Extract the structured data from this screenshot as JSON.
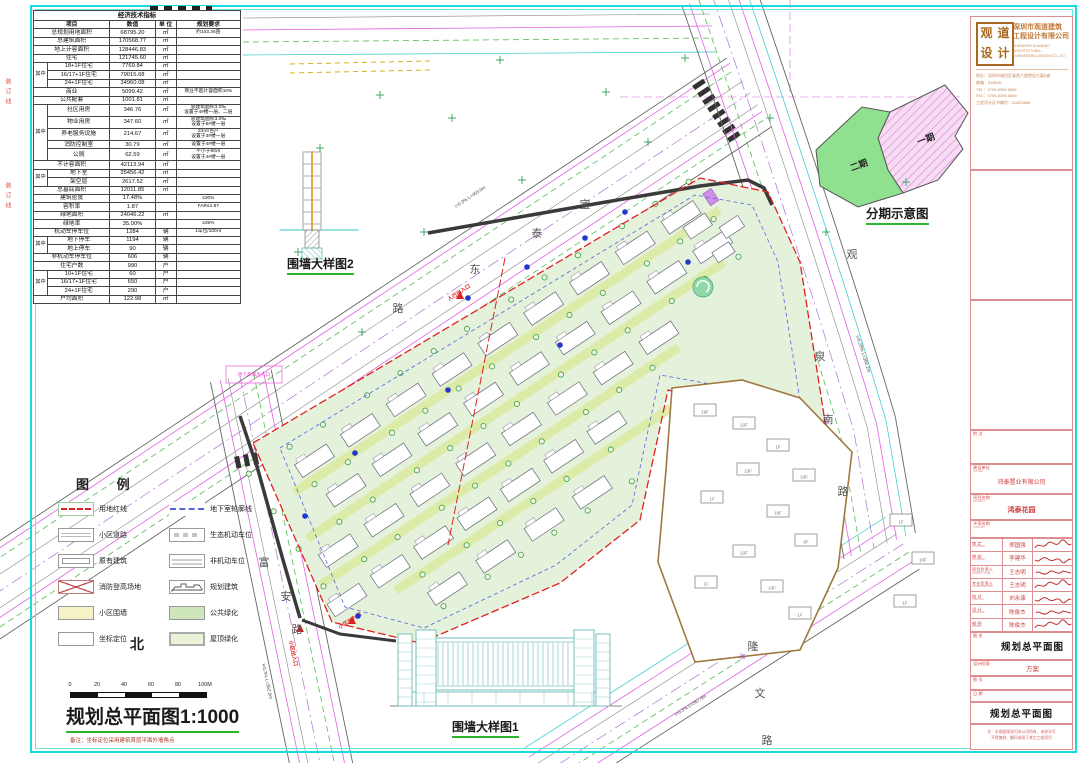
{
  "indicators_table": {
    "title": "经济技术指标",
    "headers": [
      "项目",
      "数值",
      "单 位",
      "规划要求"
    ],
    "qizhong_label": "其中",
    "rows": [
      {
        "g": 0,
        "l": "总规划用地面积",
        "v": "68795.20",
        "u": "㎡",
        "r": "约103.36亩"
      },
      {
        "g": 0,
        "l": "总建筑面积",
        "v": "170568.77",
        "u": "㎡",
        "r": ""
      },
      {
        "g": 0,
        "l": "地上计容面积",
        "v": "128446.83",
        "u": "㎡",
        "r": ""
      },
      {
        "g": 0,
        "l": "住宅",
        "v": "121745.60",
        "u": "㎡",
        "r": ""
      },
      {
        "g": 3,
        "l": "18+1F住宅",
        "v": "7769.84",
        "u": "㎡",
        "r": ""
      },
      {
        "g": -1,
        "l": "16/17+1F住宅",
        "v": "79015.68",
        "u": "㎡",
        "r": ""
      },
      {
        "g": -1,
        "l": "24+1F住宅",
        "v": "34960.08",
        "u": "㎡",
        "r": ""
      },
      {
        "g": 0,
        "l": "商业",
        "v": "5099.42",
        "u": "㎡",
        "r": "商业不超计容面积10%"
      },
      {
        "g": 0,
        "l": "公共配套",
        "v": "1001.81",
        "u": "㎡",
        "r": ""
      },
      {
        "g": 5,
        "l": "社区用房",
        "v": "346.76",
        "u": "㎡",
        "r": "总建筑面积3.0‰\n设置于4#楼一层、二层"
      },
      {
        "g": -1,
        "l": "物业用房",
        "v": "347.60",
        "u": "㎡",
        "r": "总建筑面积3.0‰\n设置于5#楼一层"
      },
      {
        "g": -1,
        "l": "养老服务设施",
        "v": "214.67",
        "u": "㎡",
        "r": "20㎡/百户\n设置于3#楼一层"
      },
      {
        "g": -1,
        "l": "消防控制室",
        "v": "30.79",
        "u": "㎡",
        "r": "设置于4#楼一层"
      },
      {
        "g": -1,
        "l": "公厕",
        "v": "62.59",
        "u": "㎡",
        "r": "不小于60㎡\n设置于4#楼一层"
      },
      {
        "g": 0,
        "l": "不计容面积",
        "v": "42113.94",
        "u": "㎡",
        "r": ""
      },
      {
        "g": 2,
        "l": "地下室",
        "v": "35456.42",
        "u": "㎡",
        "r": ""
      },
      {
        "g": -1,
        "l": "架空层",
        "v": "2617.52",
        "u": "㎡",
        "r": ""
      },
      {
        "g": 0,
        "l": "总基底面积",
        "v": "12011.85",
        "u": "㎡",
        "r": ""
      },
      {
        "g": 0,
        "l": "建筑密度",
        "v": "17.48%",
        "u": "",
        "r": "≤30%"
      },
      {
        "g": 0,
        "l": "容积率",
        "v": "1.87",
        "u": "",
        "r": "FAR≤1.87"
      },
      {
        "g": 0,
        "l": "绿地面积",
        "v": "24046.22",
        "u": "㎡",
        "r": ""
      },
      {
        "g": 0,
        "l": "绿地率",
        "v": "35.00%",
        "u": "",
        "r": "≥35%"
      },
      {
        "g": 0,
        "l": "机动车停车位",
        "v": "1284",
        "u": "辆",
        "r": "1车位/100㎡"
      },
      {
        "g": 2,
        "l": "地下停车",
        "v": "1194",
        "u": "辆",
        "r": ""
      },
      {
        "g": -1,
        "l": "地上停车",
        "v": "90",
        "u": "辆",
        "r": ""
      },
      {
        "g": 0,
        "l": "非机动车停车位",
        "v": "606",
        "u": "辆",
        "r": ""
      },
      {
        "g": 0,
        "l": "住宅户数",
        "v": "990",
        "u": "户",
        "r": ""
      },
      {
        "g": 3,
        "l": "10+1F住宅",
        "v": "60",
        "u": "户",
        "r": ""
      },
      {
        "g": -1,
        "l": "16/17+1F住宅",
        "v": "650",
        "u": "户",
        "r": ""
      },
      {
        "g": -1,
        "l": "24+1F住宅",
        "v": "290",
        "u": "户",
        "r": ""
      },
      {
        "g": 0,
        "l": "户均面积",
        "v": "122.98",
        "u": "㎡",
        "r": ""
      }
    ]
  },
  "legend": {
    "title": "图  例",
    "left": [
      {
        "t": "用地红线",
        "type": "reddash"
      },
      {
        "t": "小区道路",
        "type": "road"
      },
      {
        "t": "原有建筑",
        "type": "existing"
      },
      {
        "t": "消防登高场地",
        "type": "fire"
      },
      {
        "t": "小区围墙",
        "type": "wall"
      },
      {
        "t": "坐标定位",
        "type": "coord"
      }
    ],
    "right": [
      {
        "t": "地下室轮廓线",
        "type": "bluedash"
      },
      {
        "t": "生态机动车位",
        "type": "eco"
      },
      {
        "t": "非机动车位",
        "type": "bike"
      },
      {
        "t": "规划建筑",
        "type": "planned"
      },
      {
        "t": "公共绿化",
        "type": "green"
      },
      {
        "t": "屋顶绿化",
        "type": "roof"
      }
    ]
  },
  "plan": {
    "north": "北",
    "title": "规划总平面图1:1000",
    "note": "备注：坐标定位采用建筑首层平面外墙角点",
    "scale_ticks": [
      "0",
      "20",
      "40",
      "60",
      "80",
      "100M"
    ],
    "roads": [
      "宝泰东路",
      "富安路",
      "观泉南路",
      "隆文路"
    ],
    "entrances": [
      "小区出入口",
      "小区出入口",
      "人行出入口"
    ],
    "slope_notes": [
      "i=0.3% L=453.0m",
      "i=0.25% L=360.2m",
      "i=0.3% L=367.4m",
      "i=0.3% L=362.5m"
    ],
    "garage_label": "地下车库出入口",
    "village_floors": [
      {
        "f": "19F",
        "x": 705,
        "y": 419
      },
      {
        "f": "10F",
        "x": 744,
        "y": 432
      },
      {
        "f": "1F",
        "x": 778,
        "y": 454
      },
      {
        "f": "10F",
        "x": 804,
        "y": 484
      },
      {
        "f": "13F",
        "x": 748,
        "y": 478
      },
      {
        "f": "1F",
        "x": 712,
        "y": 506
      },
      {
        "f": "10F",
        "x": 778,
        "y": 520
      },
      {
        "f": "9F",
        "x": 806,
        "y": 549
      },
      {
        "f": "10F",
        "x": 744,
        "y": 560
      },
      {
        "f": "1F",
        "x": 706,
        "y": 591
      },
      {
        "f": "10F",
        "x": 772,
        "y": 595
      },
      {
        "f": "1F",
        "x": 800,
        "y": 622
      },
      {
        "f": "1F",
        "x": 901,
        "y": 529
      },
      {
        "f": "10F",
        "x": 923,
        "y": 567
      },
      {
        "f": "1F",
        "x": 905,
        "y": 610
      }
    ]
  },
  "details": {
    "fence1": "围墙大样图1",
    "fence2": "围墙大样图2"
  },
  "phasing": {
    "title": "分期示意图",
    "phase1": "一期",
    "phase2": "二期"
  },
  "frame": {
    "binding_text": "装订线"
  },
  "titleblock": {
    "seal": "观道设计",
    "company_cn1": "深圳市观道建筑",
    "company_cn2": "工程设计有限公司",
    "company_en1": "SHENZHEN GUANDAO ARCHITECTURAL",
    "company_en2": "ENGINEERING DESIGN CO.,LTD.",
    "addr1": "地址：深圳市福田区泰然六路雪松大厦B座",
    "addr2": "邮编：518040",
    "tel": "TEL：0755-8306 6866",
    "fax": "FAX：0755-8306 6869",
    "cert": "工程设计证书编号：A4403886",
    "notes_label": "附 注",
    "owner_label": "建设单位",
    "owner_label_en": "OWNER",
    "owner": "鸿泰置业有限公司",
    "project_label": "项目名称",
    "project_label_en": "PROJECT",
    "project": "鸿泰花园",
    "sub_label": "子项名称",
    "sub_label_en": "SUBITEM",
    "sign_rows": [
      {
        "label": "审 定",
        "en": "APPROVED",
        "name": "郑国强"
      },
      {
        "label": "审 核",
        "en": "REVIEWED",
        "name": "李建华"
      },
      {
        "label": "项目负责人",
        "en": "PROJECT CHIEF",
        "name": "王志明"
      },
      {
        "label": "专业负责人",
        "en": "DISCIPLINE CHIEF",
        "name": "王志明"
      },
      {
        "label": "校 对",
        "en": "CHECKED",
        "name": "刘永康"
      },
      {
        "label": "设 计",
        "en": "DESIGNED",
        "name": "陈俊杰"
      },
      {
        "label": "制 图",
        "en": "DRAWN",
        "name": "陈俊杰"
      }
    ],
    "dwg_name_label": "图 名",
    "dwg_name": "规划总平面图",
    "stage_label": "设计阶段",
    "stage": "方案",
    "dwg_no_label": "图 号",
    "dwg_no": "",
    "date_label": "日 期",
    "date": "",
    "dwg_name2": "规划总平面图",
    "note1": "注：本图纸版权归本公司所有，未经许可",
    "note2": "不得复制、翻印或用于其它工程项目"
  }
}
